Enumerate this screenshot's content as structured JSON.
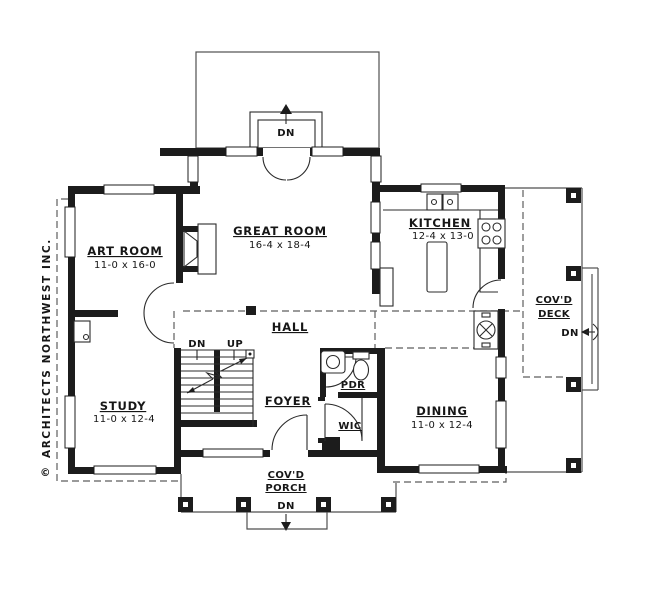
{
  "colors": {
    "ink": "#1c1c1c",
    "thin_line": "#2b2b2b",
    "soft_line": "#4f4f4f"
  },
  "credit": {
    "symbol": "©",
    "name": "ARCHITECTS NORTHWEST INC."
  },
  "rooms": {
    "art": {
      "name": "ART ROOM",
      "dims": "11-0 x 16-0"
    },
    "great": {
      "name": "GREAT ROOM",
      "dims": "16-4 x 18-4"
    },
    "kitchen": {
      "name": "KITCHEN",
      "dims": "12-4 x 13-0"
    },
    "study": {
      "name": "STUDY",
      "dims": "11-0 x 12-4"
    },
    "dining": {
      "name": "DINING",
      "dims": "11-0 x 12-4"
    },
    "hall": {
      "name": "HALL"
    },
    "foyer": {
      "name": "FOYER"
    },
    "pdr": {
      "name": "PDR"
    },
    "wic": {
      "name": "WIC"
    },
    "deck": {
      "line1": "COV'D",
      "line2": "DECK"
    },
    "porch": {
      "line1": "COV'D",
      "line2": "PORCH"
    }
  },
  "stairs": {
    "dn": "DN",
    "up": "UP"
  },
  "arrows": {
    "rear_dn": "DN",
    "deck_dn": "DN",
    "porch_dn": "DN"
  }
}
